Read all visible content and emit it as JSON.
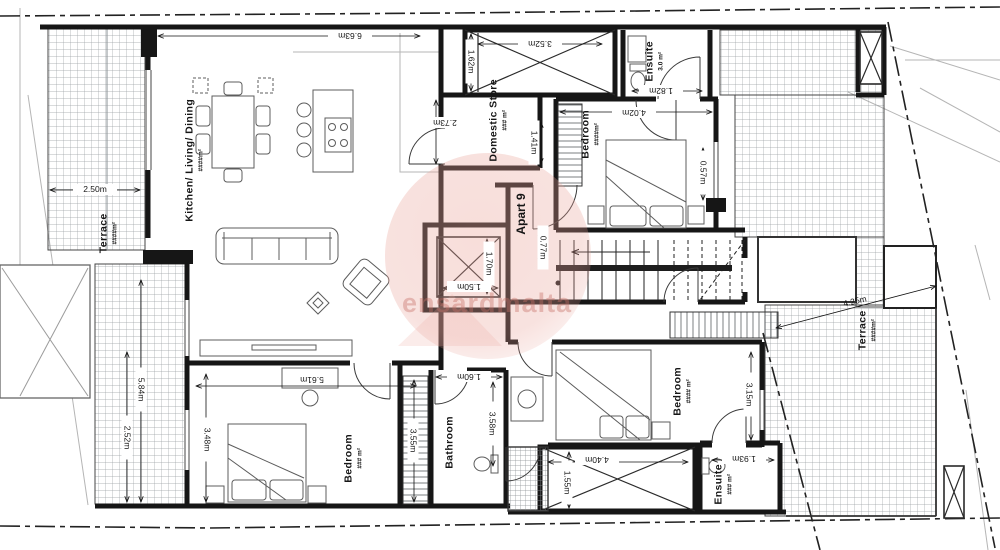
{
  "plan": {
    "apartment_label": "Apart 9",
    "watermark_text": "ensardmalta",
    "rooms": {
      "kitchen_living_dining": {
        "name": "Kitchen/ Living/ Dining",
        "area": "####m²"
      },
      "domestic_store": {
        "name": "Domestic Store",
        "area": "### m²"
      },
      "ensuite_top": {
        "name": "Ensuite",
        "area": "3.0 m²"
      },
      "bedroom_top": {
        "name": "Bedroom",
        "area": "####m²"
      },
      "bedroom_left": {
        "name": "Bedroom",
        "area": "### m²"
      },
      "bedroom_right": {
        "name": "Bedroom",
        "area": "#### m²"
      },
      "bathroom": {
        "name": "Bathroom"
      },
      "ensuite_bottom": {
        "name": "Ensuite",
        "area": "### m²"
      },
      "terrace_left": {
        "name": "Terrace",
        "area": "####m²"
      },
      "terrace_right": {
        "name": "Terrace",
        "area": "####m²"
      }
    },
    "dimensions": {
      "living_width": "6.63m",
      "terrace_left_width": "2.50m",
      "shaft_top_width": "3.52m",
      "shaft_top_depth": "1.62m",
      "store_height": "2.73m",
      "store_depth": "1.41m",
      "ensuite_top_width": "1.82m",
      "bedroom_top_width": "4.02m",
      "wall_step": "0.57m",
      "hall_width": "0.77m",
      "lift_depth": "1.70m",
      "lift_width": "1.50m",
      "terrace_left_len1": "5.84m",
      "terrace_left_len2": "2.52m",
      "bedroom_left_width": "5.61m",
      "bedroom_left_depth": "3.48m",
      "wardrobe_len": "3.55m",
      "bathroom_width": "1.60m",
      "bathroom_len": "3.58m",
      "shaft_bottom_depth": "1.55m",
      "shaft_bottom_width": "4.40m",
      "ensuite_bottom_width": "1.93m",
      "terrace_right_width": "3.15m",
      "terrace_right_diag": "4.25m"
    }
  }
}
